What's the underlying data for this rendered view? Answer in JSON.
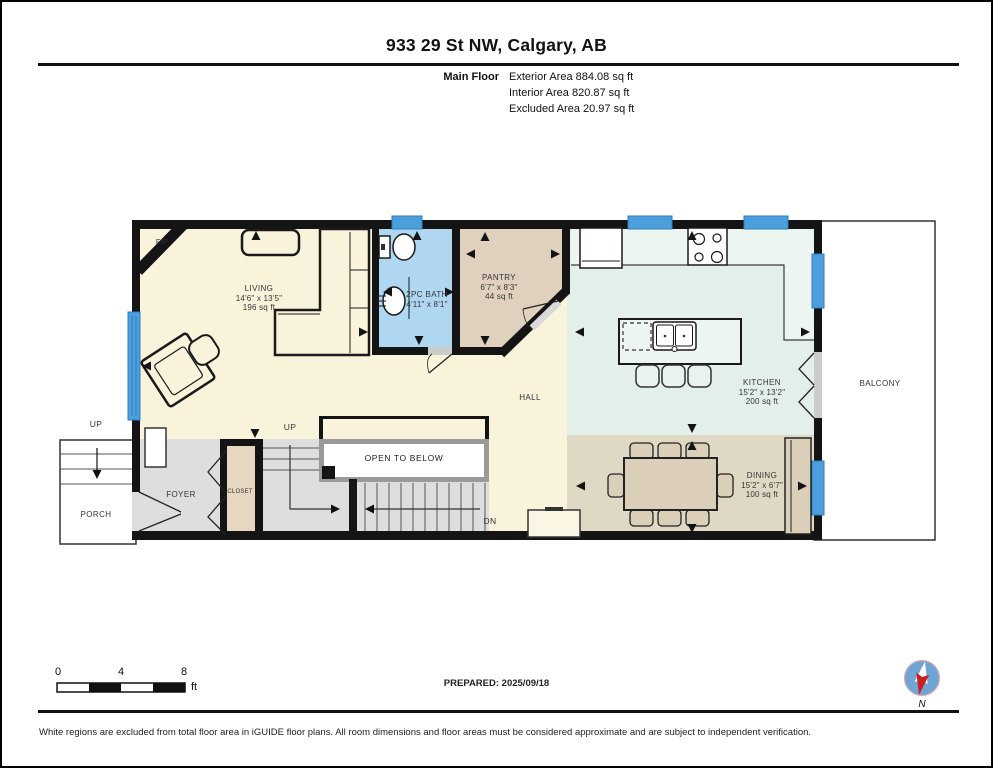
{
  "header": {
    "title": "933 29 St NW, Calgary, AB",
    "floor_label": "Main Floor",
    "areas": {
      "exterior": "Exterior Area 884.08 sq ft",
      "interior": "Interior Area 820.87 sq ft",
      "excluded": "Excluded Area 20.97 sq ft"
    }
  },
  "rooms": {
    "living": {
      "name": "LIVING",
      "dims": "14'6\" x 13'5\"",
      "area": "196 sq ft"
    },
    "bath": {
      "name": "2PC BATH",
      "dims": "4'11\" x 8'1\""
    },
    "pantry": {
      "name": "PANTRY",
      "dims": "6'7\" x 8'3\"",
      "area": "44 sq ft"
    },
    "kitchen": {
      "name": "KITCHEN",
      "dims": "15'2\" x 13'2\"",
      "area": "200 sq ft"
    },
    "dining": {
      "name": "DINING",
      "dims": "15'2\" x 6'7\"",
      "area": "100 sq ft"
    },
    "hall": {
      "name": "HALL"
    },
    "foyer": {
      "name": "FOYER"
    },
    "closet": {
      "name": "CLOSET"
    },
    "porch": {
      "name": "PORCH"
    },
    "balcony": {
      "name": "BALCONY"
    },
    "open_to_below": {
      "name": "OPEN TO BELOW"
    },
    "fireplace": {
      "name": "F/P"
    }
  },
  "stairs": {
    "up_porch": "UP",
    "up_main": "UP",
    "down": "DN"
  },
  "scale_bar": {
    "tick_0": "0",
    "tick_4": "4",
    "tick_8": "8",
    "unit": "ft"
  },
  "footer": {
    "prepared": "PREPARED: 2025/09/18",
    "compass_label": "N",
    "disclaimer": "White regions are excluded from total floor area in iGUIDE floor plans. All room dimensions and floor areas must be considered approximate and are subject to independent verification."
  },
  "colors": {
    "wall": "#141414",
    "window_blue": "#4D9FDB",
    "living_cream": "#FAF3DB",
    "bath_blue": "#AFD7F1",
    "pantry_tan": "#DFD1BE",
    "kitchen_green": "#E3F0E9",
    "dining_beige": "#DFD8C4",
    "circulation_gray": "#DEDEDE",
    "excluded_white": "#FFFFFF"
  }
}
